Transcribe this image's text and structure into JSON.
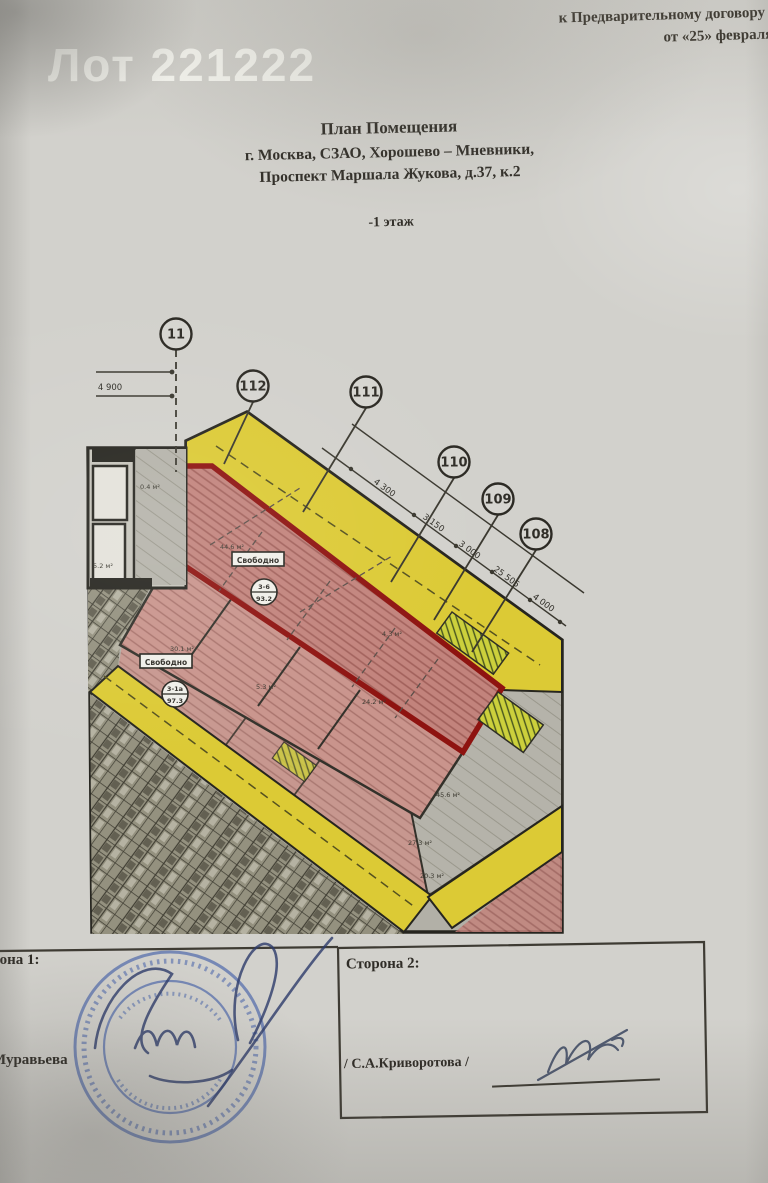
{
  "watermark": "Лот 221222",
  "doc_ref": {
    "line1": "Приложени",
    "line2": "к Предварительному договору №",
    "line3": "от «25» февраля 2"
  },
  "title_block": {
    "title": "План Помещения",
    "address1": "г. Москва, СЗАО, Хорошево – Мневники,",
    "address2": "Проспект Маршала Жукова, д.37, к.2",
    "floor": "-1 этаж"
  },
  "plan": {
    "colors": {
      "corridor_yellow": "#dcca35",
      "unit_fill_pink": "#c2837c",
      "highlight_outline_red": "#8e1310",
      "wall_dark": "#26251f",
      "paper": "#d2d1cc",
      "stamp_blue": "#3f5da8"
    },
    "axes": [
      {
        "id": "11",
        "cx": 176,
        "cy": 334,
        "x2": 176,
        "y2": 472,
        "dash": true
      },
      {
        "id": "112",
        "cx": 253,
        "cy": 386,
        "x2": 224,
        "y2": 464,
        "dash": false
      },
      {
        "id": "111",
        "cx": 366,
        "cy": 392,
        "x2": 303,
        "y2": 512,
        "dash": false
      },
      {
        "id": "110",
        "cx": 454,
        "cy": 462,
        "x2": 391,
        "y2": 582,
        "dash": false
      },
      {
        "id": "109",
        "cx": 498,
        "cy": 499,
        "x2": 434,
        "y2": 620,
        "dash": false
      },
      {
        "id": "108",
        "cx": 536,
        "cy": 534,
        "x2": 472,
        "y2": 652,
        "dash": false
      }
    ],
    "dim_labels": [
      {
        "text": "4 900",
        "x": 110,
        "y": 390,
        "rot": 0
      },
      {
        "text": "4 300",
        "x": 383,
        "y": 490,
        "rot": 36
      },
      {
        "text": "3 150",
        "x": 432,
        "y": 525,
        "rot": 36
      },
      {
        "text": "3 000",
        "x": 468,
        "y": 552,
        "rot": 36
      },
      {
        "text": "25 505",
        "x": 505,
        "y": 579,
        "rot": 36
      },
      {
        "text": "4 000",
        "x": 542,
        "y": 605,
        "rot": 36
      }
    ],
    "units": [
      {
        "status": "Свободно",
        "number": "3-6",
        "area": "93.2",
        "bx": 258,
        "by": 560,
        "ccx": 264,
        "ccy": 592
      },
      {
        "status": "Свободно",
        "number": "3-1а",
        "area": "97.3",
        "bx": 166,
        "by": 662,
        "ccx": 175,
        "ccy": 694
      }
    ],
    "area_labels": [
      {
        "text": "0.4 м²",
        "x": 150,
        "y": 489
      },
      {
        "text": "5.2 м²",
        "x": 103,
        "y": 568
      },
      {
        "text": "44.6 м²",
        "x": 232,
        "y": 549
      },
      {
        "text": "30.1 м²",
        "x": 182,
        "y": 651
      },
      {
        "text": "4.3 м²",
        "x": 392,
        "y": 636
      },
      {
        "text": "5.3 м²",
        "x": 266,
        "y": 689
      },
      {
        "text": "24.2 м²",
        "x": 374,
        "y": 704
      },
      {
        "text": "45.6 м²",
        "x": 448,
        "y": 797
      },
      {
        "text": "27.3 м²",
        "x": 420,
        "y": 845
      },
      {
        "text": "20.3 м²",
        "x": 432,
        "y": 878
      }
    ]
  },
  "signatures": {
    "party1_label": "Сторона 1:",
    "party1_name": "Муравьева",
    "party2_label": "Сторона 2:",
    "party2_name": "/ С.А.Криворотова /"
  }
}
